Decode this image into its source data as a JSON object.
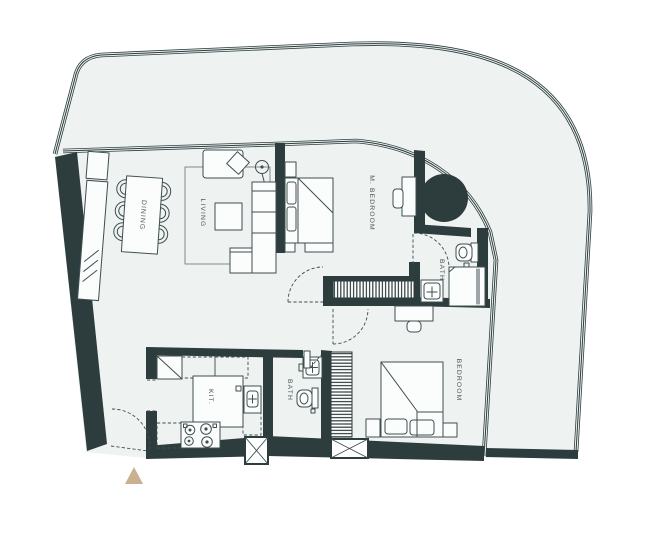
{
  "plan": {
    "title": "apartment-floor-plan",
    "rooms": {
      "dining": {
        "label": "DINING"
      },
      "living": {
        "label": "LIVING"
      },
      "master_bedroom": {
        "label": "M. BEDROOM"
      },
      "master_bath": {
        "label": "BATH"
      },
      "kitchen": {
        "label": "KIT."
      },
      "bath": {
        "label": "BATH"
      },
      "bedroom": {
        "label": "BEDROOM"
      }
    },
    "colors": {
      "wall": "#2d3c3d",
      "floor": "#eef2f1",
      "furniture_line": "#3f4e4f",
      "label_text": "#4c5a5a",
      "entrance_marker": "#c9b093",
      "background": "#ffffff"
    }
  }
}
